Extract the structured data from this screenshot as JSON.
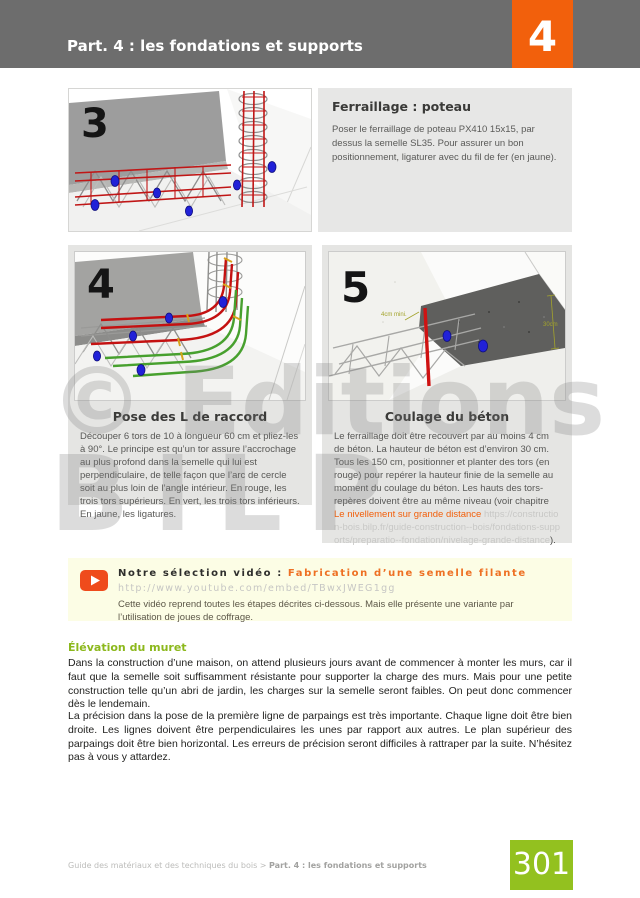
{
  "header": {
    "title": "Part. 4 : les fondations et supports",
    "chapter": "4"
  },
  "steps": {
    "s3": {
      "number": "3",
      "title": "Ferraillage : poteau",
      "text": "Poser le ferraillage de poteau PX410 15x15, par dessus la semelle SL35. Pour assurer un bon positionnement, ligaturer avec du fil de fer (en jaune)."
    },
    "s4": {
      "number": "4",
      "caption": "Pose des L de raccord",
      "text": "Découper 6 tors de 10 à longueur 60 cm et pliez-les à 90°. Le principe est qu’un tor assure l’accrochage au plus profond dans la semelle qui lui est perpendiculaire, de telle façon que l’arc de cercle soit au plus loin de l’angle intérieur. En rouge, les trois tors supérieurs. En vert, les trois tors inférieurs. En jaune, les ligatures."
    },
    "s5": {
      "number": "5",
      "caption": "Coulage du béton",
      "text_before": "Le ferraillage doit être recouvert par au moins 4 cm de béton. La hauteur de béton est d’environ 30 cm. Tous les 150 cm, positionner et planter des tors (en rouge) pour repérer la hauteur finie de la semelle au moment du coulage du béton. Les hauts des tors-repères doivent être au même niveau (voir chapitre ",
      "link_text": "Le nivellement sur grande distance",
      "url_text": " https://construction-bois.bilp.fr/guide-construction--bois/fondations-supports/preparatio--fondation/nivelage-grande-distance",
      "suffix": ").",
      "dim_cover": "4cm mini.",
      "dim_height": "30cm"
    }
  },
  "watermark": {
    "line1": "© Editions",
    "line2": "BILP"
  },
  "video": {
    "label": "Notre sélection vidéo : ",
    "title": "Fabrication d’une semelle filante",
    "url": "http://www.youtube.com/embed/TBwxJWEG1gg",
    "description": "Cette vidéo reprend toutes les étapes décrites ci-dessous. Mais elle présente une variante par l’utilisation de joues de coffrage."
  },
  "article": {
    "heading": "Élévation du muret",
    "para1": "Dans la construction d’une maison, on attend plusieurs jours avant de commencer à monter les murs, car il faut que la semelle soit suffisamment résistante pour supporter la charge des murs. Mais pour une petite construction telle qu’un abri de jardin, les charges sur la semelle seront faibles. On peut donc commencer dès le lendemain.",
    "para2": "La précision dans la pose de la première ligne de parpaings est très importante. Chaque ligne doit être bien droite. Les lignes doivent être perpendiculaires les unes par rapport aux autres. Le plan supérieur des parpaings doit être bien horizontal. Les erreurs de précision seront difficiles à rattraper par la suite. N’hésitez pas à vous y attardez."
  },
  "footer": {
    "breadcrumb": "Guide des matériaux et des techniques du bois > ",
    "section": "Part. 4 : les fondations et supports",
    "page_number": "301"
  },
  "colors": {
    "accent_orange": "#f2600c",
    "link_orange": "#f2600c",
    "page_green": "#93c11f",
    "header_gray": "#6d6d6d",
    "panel_gray": "#e5e5e3",
    "video_background": "#fcfde5"
  }
}
